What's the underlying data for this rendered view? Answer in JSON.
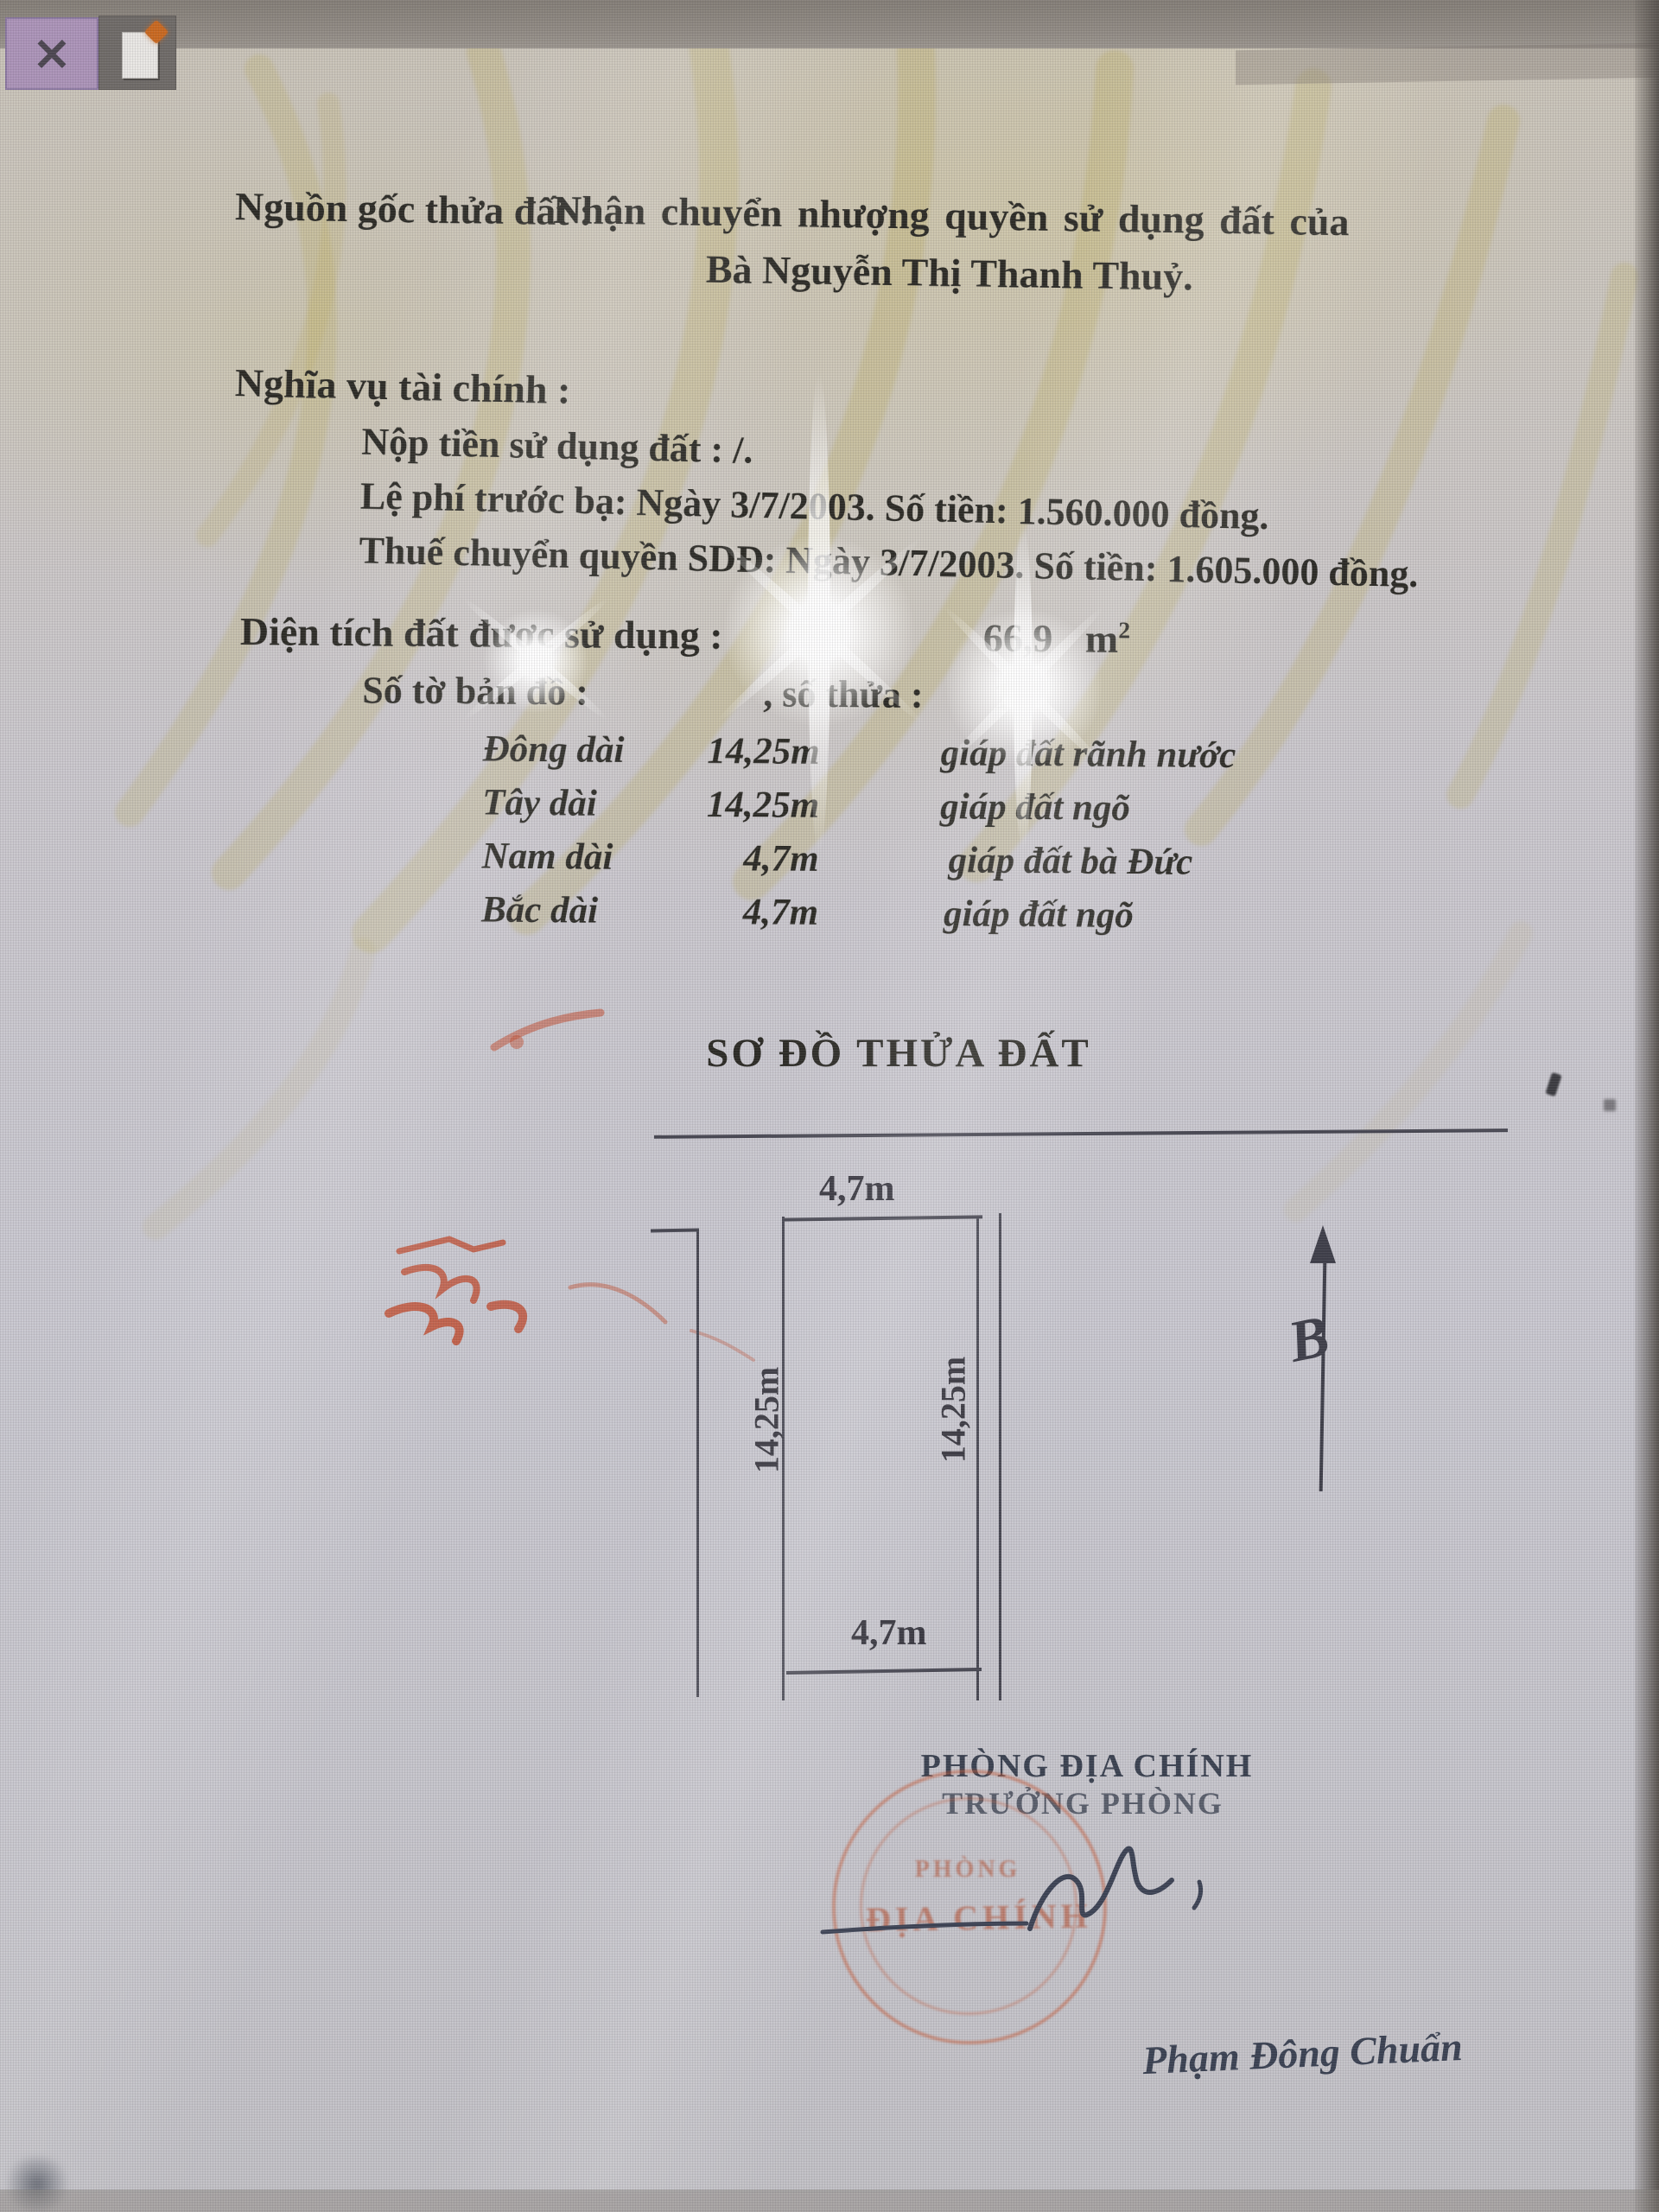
{
  "window": {
    "close_glyph": "×"
  },
  "colors": {
    "stamp_red": "#c55c3a",
    "close_button_bg": "#ab93b8",
    "spark_orange": "#c9681f",
    "watermark_olive": "#b9a845",
    "ink_dark": "#2b2a25",
    "signature_ink": "#3c4254"
  },
  "doc": {
    "origin": {
      "label": "Nguồn gốc thửa đất :",
      "text1": "Nhận chuyển  nhượng quyền sử dụng đất của",
      "text2": "Bà Nguyễn Thị Thanh Thuỷ."
    },
    "finance": {
      "heading": "Nghĩa vụ tài chính :",
      "items": [
        "Nộp tiền sử dụng đất : /.",
        "Lệ phí trước bạ: Ngày 3/7/2003. Số tiền: 1.560.000 đồng.",
        "Thuế chuyển quyền SDĐ: Ngày 3/7/2003. Số tiền: 1.605.000 đồng."
      ]
    },
    "area": {
      "label": "Diện tích đất được sử dụng :",
      "value": "66,9",
      "unit": "m",
      "sup": "2"
    },
    "map": {
      "label": "Số tờ bản đồ :",
      "thua_label": ", số thửa :",
      "thua_value": "1"
    },
    "boundaries": [
      {
        "side": "Đông dài",
        "length": "14,25m",
        "adjacent": "giáp đất rãnh nước"
      },
      {
        "side": "Tây dài",
        "length": "14,25m",
        "adjacent": "giáp đất ngõ"
      },
      {
        "side": "Nam dài",
        "length": "4,7m",
        "adjacent": "giáp đất bà Đức"
      },
      {
        "side": "Bắc dài",
        "length": "4,7m",
        "adjacent": "giáp đất ngõ"
      }
    ],
    "plot": {
      "title": "SƠ ĐỒ THỬA ĐẤT",
      "top_width": "4,7m",
      "bottom_width": "4,7m",
      "left_length": "14,25m",
      "right_length": "14,25m",
      "north": "B"
    },
    "stamp": {
      "line1": "PHÒNG",
      "line2": "ĐỊA CHÍNH"
    },
    "sign": {
      "office": "PHÒNG ĐỊA CHÍNH",
      "title": "TRƯỞNG PHÒNG",
      "name": "Phạm Đông Chuẩn"
    }
  }
}
